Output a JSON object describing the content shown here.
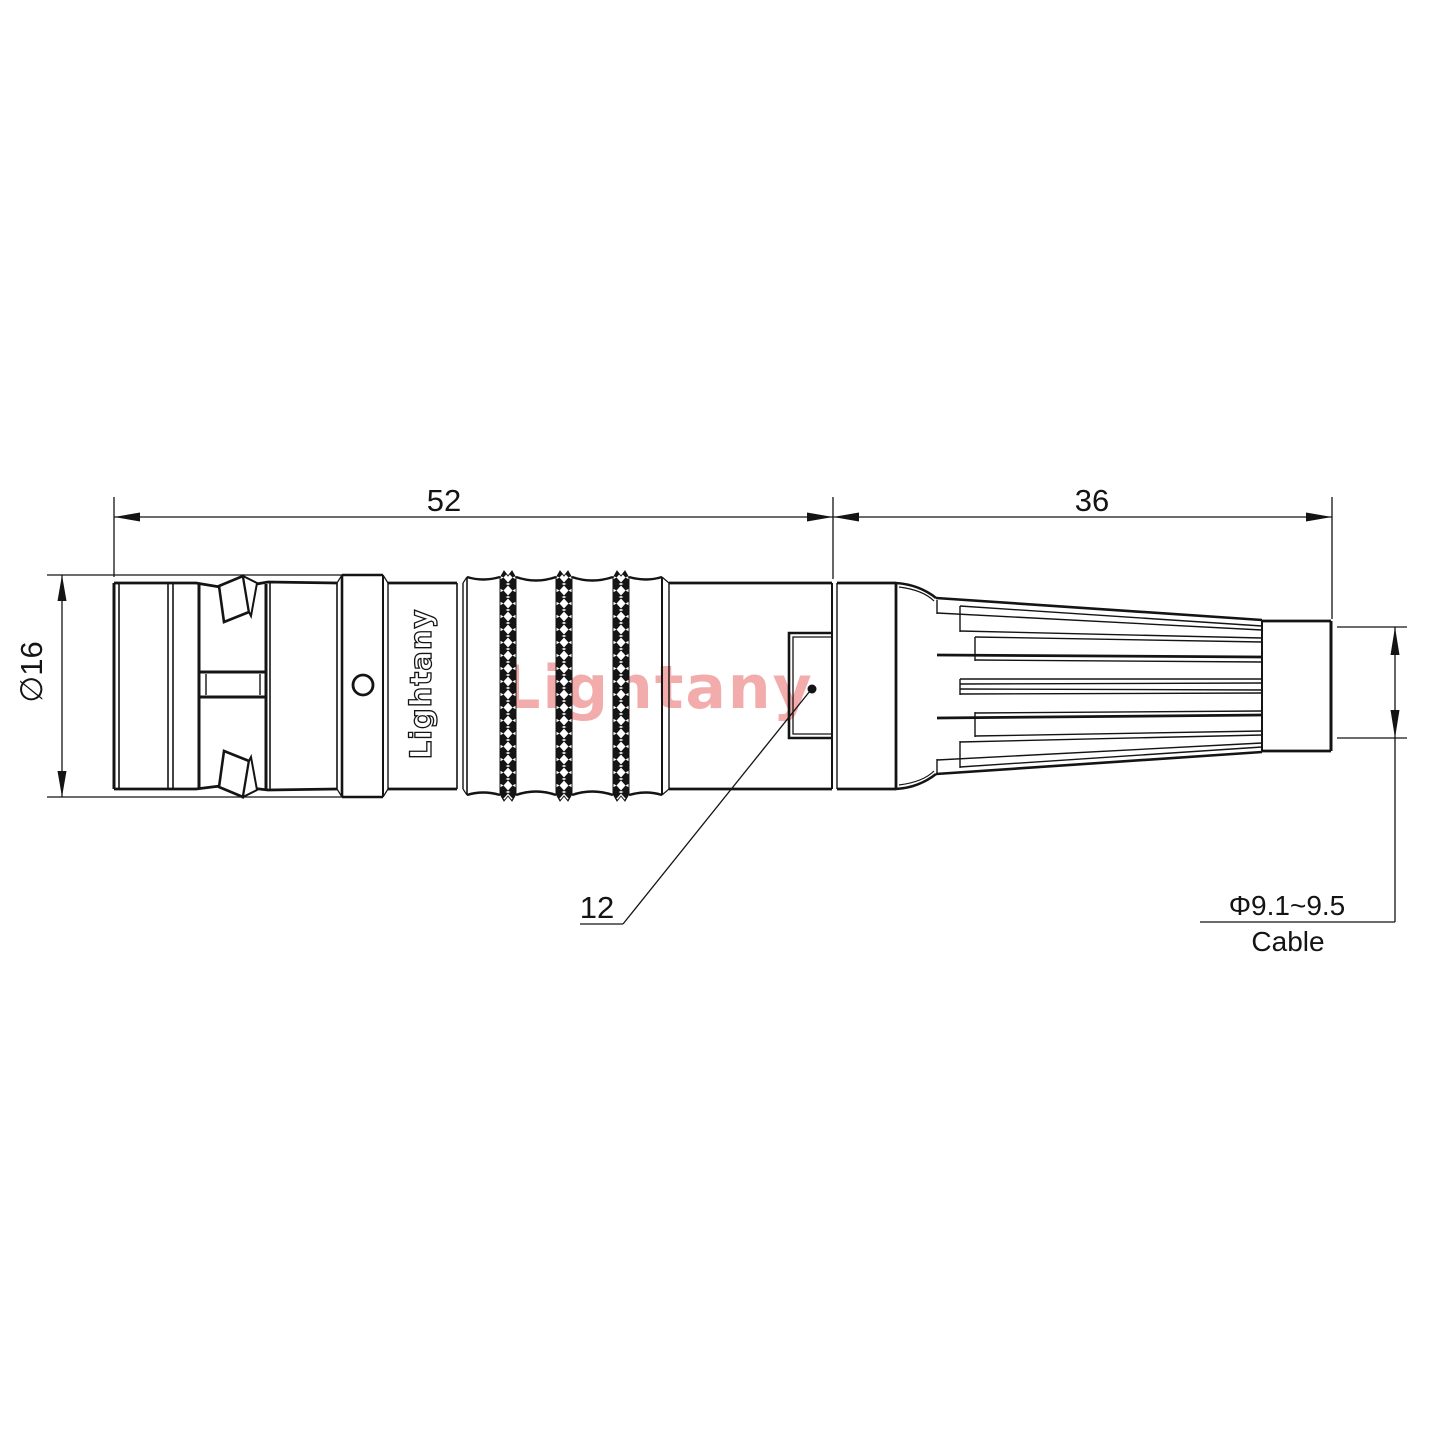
{
  "drawing": {
    "watermark": "Lightany",
    "body_brand": "Lightany",
    "dims": {
      "overall_length": "52",
      "boot_length": "36",
      "body_diameter": "∅16",
      "key_size": "12",
      "cable_diameter": "Φ9.1~9.5",
      "cable_label": "Cable"
    },
    "colors": {
      "line": "#141414",
      "watermark": "#f3acac",
      "background": "#ffffff"
    }
  }
}
